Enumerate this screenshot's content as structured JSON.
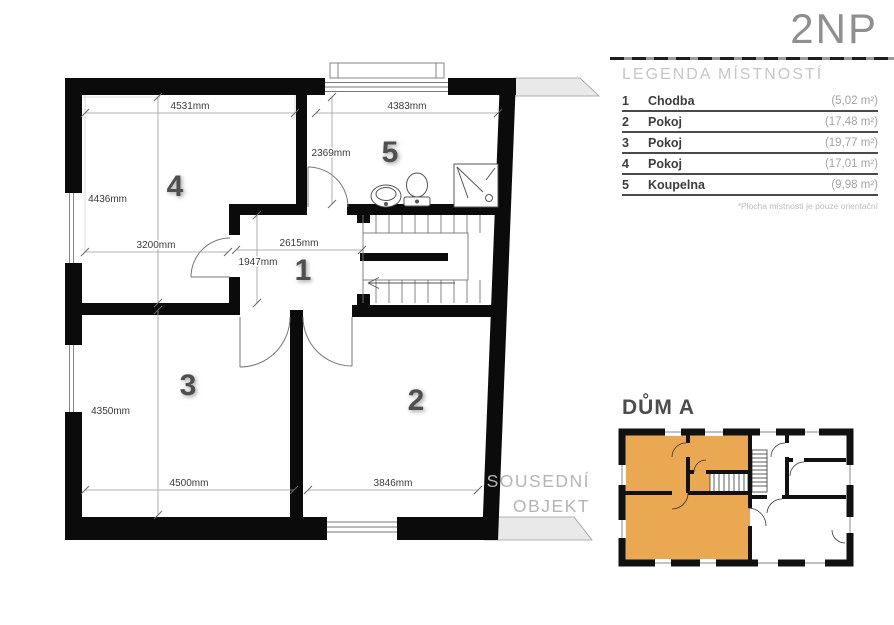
{
  "header": {
    "floor_label": "2NP"
  },
  "legend": {
    "title": "LEGENDA MÍSTNOSTÍ",
    "rows": [
      {
        "num": "1",
        "name": "Chodba",
        "area": "(5,02 m²)"
      },
      {
        "num": "2",
        "name": "Pokoj",
        "area": "(17,48 m²)"
      },
      {
        "num": "3",
        "name": "Pokoj",
        "area": "(19,77 m²)"
      },
      {
        "num": "4",
        "name": "Pokoj",
        "area": "(17,01 m²)"
      },
      {
        "num": "5",
        "name": "Koupelna",
        "area": "(9,98 m²)"
      }
    ],
    "footnote": "*Plocha místností je pouze orientační"
  },
  "plan": {
    "room_labels": {
      "r1": "1",
      "r2": "2",
      "r3": "3",
      "r4": "4",
      "r5": "5"
    },
    "dims": {
      "d4531": "4531mm",
      "d4436": "4436mm",
      "d3200": "3200mm",
      "d4383": "4383mm",
      "d2369": "2369mm",
      "d2615": "2615mm",
      "d1947": "1947mm",
      "d4350": "4350mm",
      "d4500": "4500mm",
      "d3846": "3846mm"
    },
    "neighbor": {
      "line1": "SOUSEDNÍ",
      "line2": "OBJEKT"
    }
  },
  "minimap": {
    "title": "DŮM A",
    "highlight_color": "#E9A851"
  },
  "colors": {
    "wall": "#0b0b0b",
    "highlight_orange": "#E9A851",
    "neighbor_fill": "#e9e9e9",
    "dim_text": "#3a3a3a",
    "legend_area_text": "#a2a2a2"
  }
}
